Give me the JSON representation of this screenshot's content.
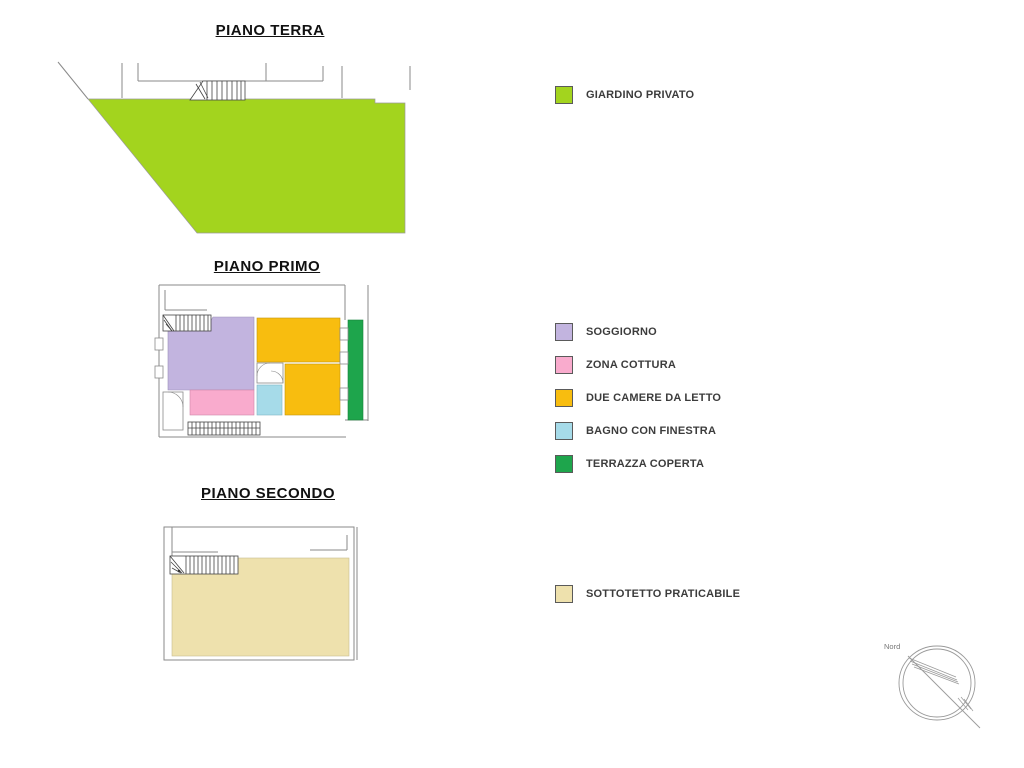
{
  "titles": {
    "terra": "PIANO TERRA",
    "primo": "PIANO PRIMO",
    "secondo": "PIANO SECONDO"
  },
  "legend": {
    "terra": [
      {
        "label": "GIARDINO PRIVATO",
        "color": "#a3d41e"
      }
    ],
    "primo": [
      {
        "label": "SOGGIORNO",
        "color": "#c2b4df"
      },
      {
        "label": "ZONA COTTURA",
        "color": "#f9abcd"
      },
      {
        "label": "DUE CAMERE DA LETTO",
        "color": "#f8bd0f"
      },
      {
        "label": "BAGNO CON FINESTRA",
        "color": "#a6dbe9"
      },
      {
        "label": "TERRAZZA COPERTA",
        "color": "#1ea54c"
      }
    ],
    "secondo": [
      {
        "label": "SOTTOTETTO PRATICABILE",
        "color": "#eee1ad"
      }
    ]
  },
  "compass": {
    "label": "Nord"
  },
  "rooms": {
    "giardino_privato": "#a3d41e",
    "soggiorno": "#c2b4df",
    "zona_cottura": "#f9abcd",
    "camere_da_letto": "#f8bd0f",
    "bagno": "#a6dbe9",
    "terrazza_coperta": "#1ea54c",
    "sottotetto": "#eee1ad"
  },
  "line_color": "#8a8a8a"
}
